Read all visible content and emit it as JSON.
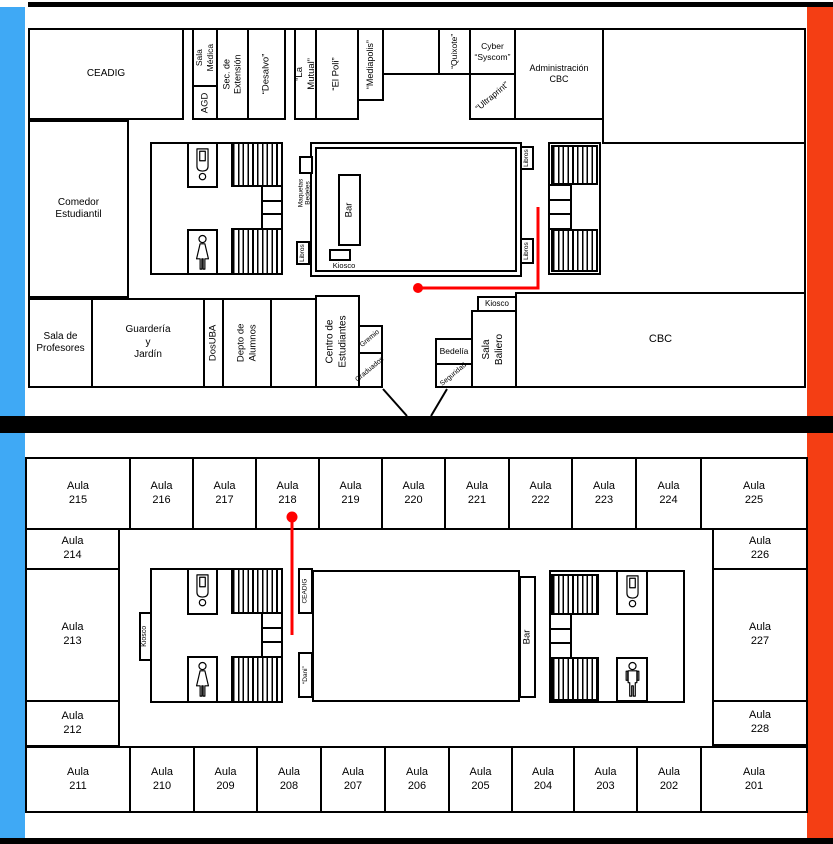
{
  "colors": {
    "left_bar": "#3FA9F5",
    "right_bar": "#F43E14",
    "route": "#FF0000",
    "wall": "#000000",
    "background": "#FFFFFF"
  },
  "icons": {
    "toilet": "toilet-icon",
    "man": "man-icon",
    "woman": "woman-icon"
  },
  "upper": {
    "ceadig": "CEADIG",
    "sala_medica": "Sala\nMédica",
    "agd": "AGD",
    "sec_extension": "Sec. de\nExtensión",
    "desalvo": "“Desalvo”",
    "la_mutual": "“La Mutual”",
    "el_poli": "“El Poli”",
    "mediapolis": "“Mediapolis”",
    "quixote": "“Quixote”",
    "cyber_syscom": "Cyber\n“Syscom”",
    "ultraprint": "“Ultraprint”",
    "administracion": "Administración\nCBC",
    "comedor": "Comedor\nEstudiantil",
    "sala_profesores": "Sala de\nProfesores",
    "guarderia": "Guardería\ny\nJardín",
    "dosuba": "DosUBA",
    "depto_alumnos": "Depto de\nAlumnos",
    "centro_estudiantes": "Centro de\nEstudiantes",
    "gremio": "Gremio",
    "graduados": "Graduados",
    "bedelia": "Bedelía",
    "seguridad": "Seguridad",
    "sala_baliero": "Sala\nBaliero",
    "kiosco_baliero": "Kiosco",
    "cbc": "CBC",
    "bar": "Bar",
    "kiosco_patio": "Kiosco",
    "maquetas": "Maquetas\nBedeles",
    "libros": "Libros"
  },
  "lower": {
    "top_row": [
      "Aula\n215",
      "Aula\n216",
      "Aula\n217",
      "Aula\n218",
      "Aula\n219",
      "Aula\n220",
      "Aula\n221",
      "Aula\n222",
      "Aula\n223",
      "Aula\n224",
      "Aula\n225"
    ],
    "left_col": [
      "Aula\n214",
      "Aula\n213",
      "Aula\n212"
    ],
    "right_col": [
      "Aula\n226",
      "Aula\n227",
      "Aula\n228"
    ],
    "bottom_row": [
      "Aula\n211",
      "Aula\n210",
      "Aula\n209",
      "Aula\n208",
      "Aula\n207",
      "Aula\n206",
      "Aula\n205",
      "Aula\n204",
      "Aula\n203",
      "Aula\n202",
      "Aula\n201"
    ],
    "kiosco": "Kiosco",
    "ceadig": "CEADIG",
    "dani": "“Dani”",
    "bar": "Bar"
  }
}
